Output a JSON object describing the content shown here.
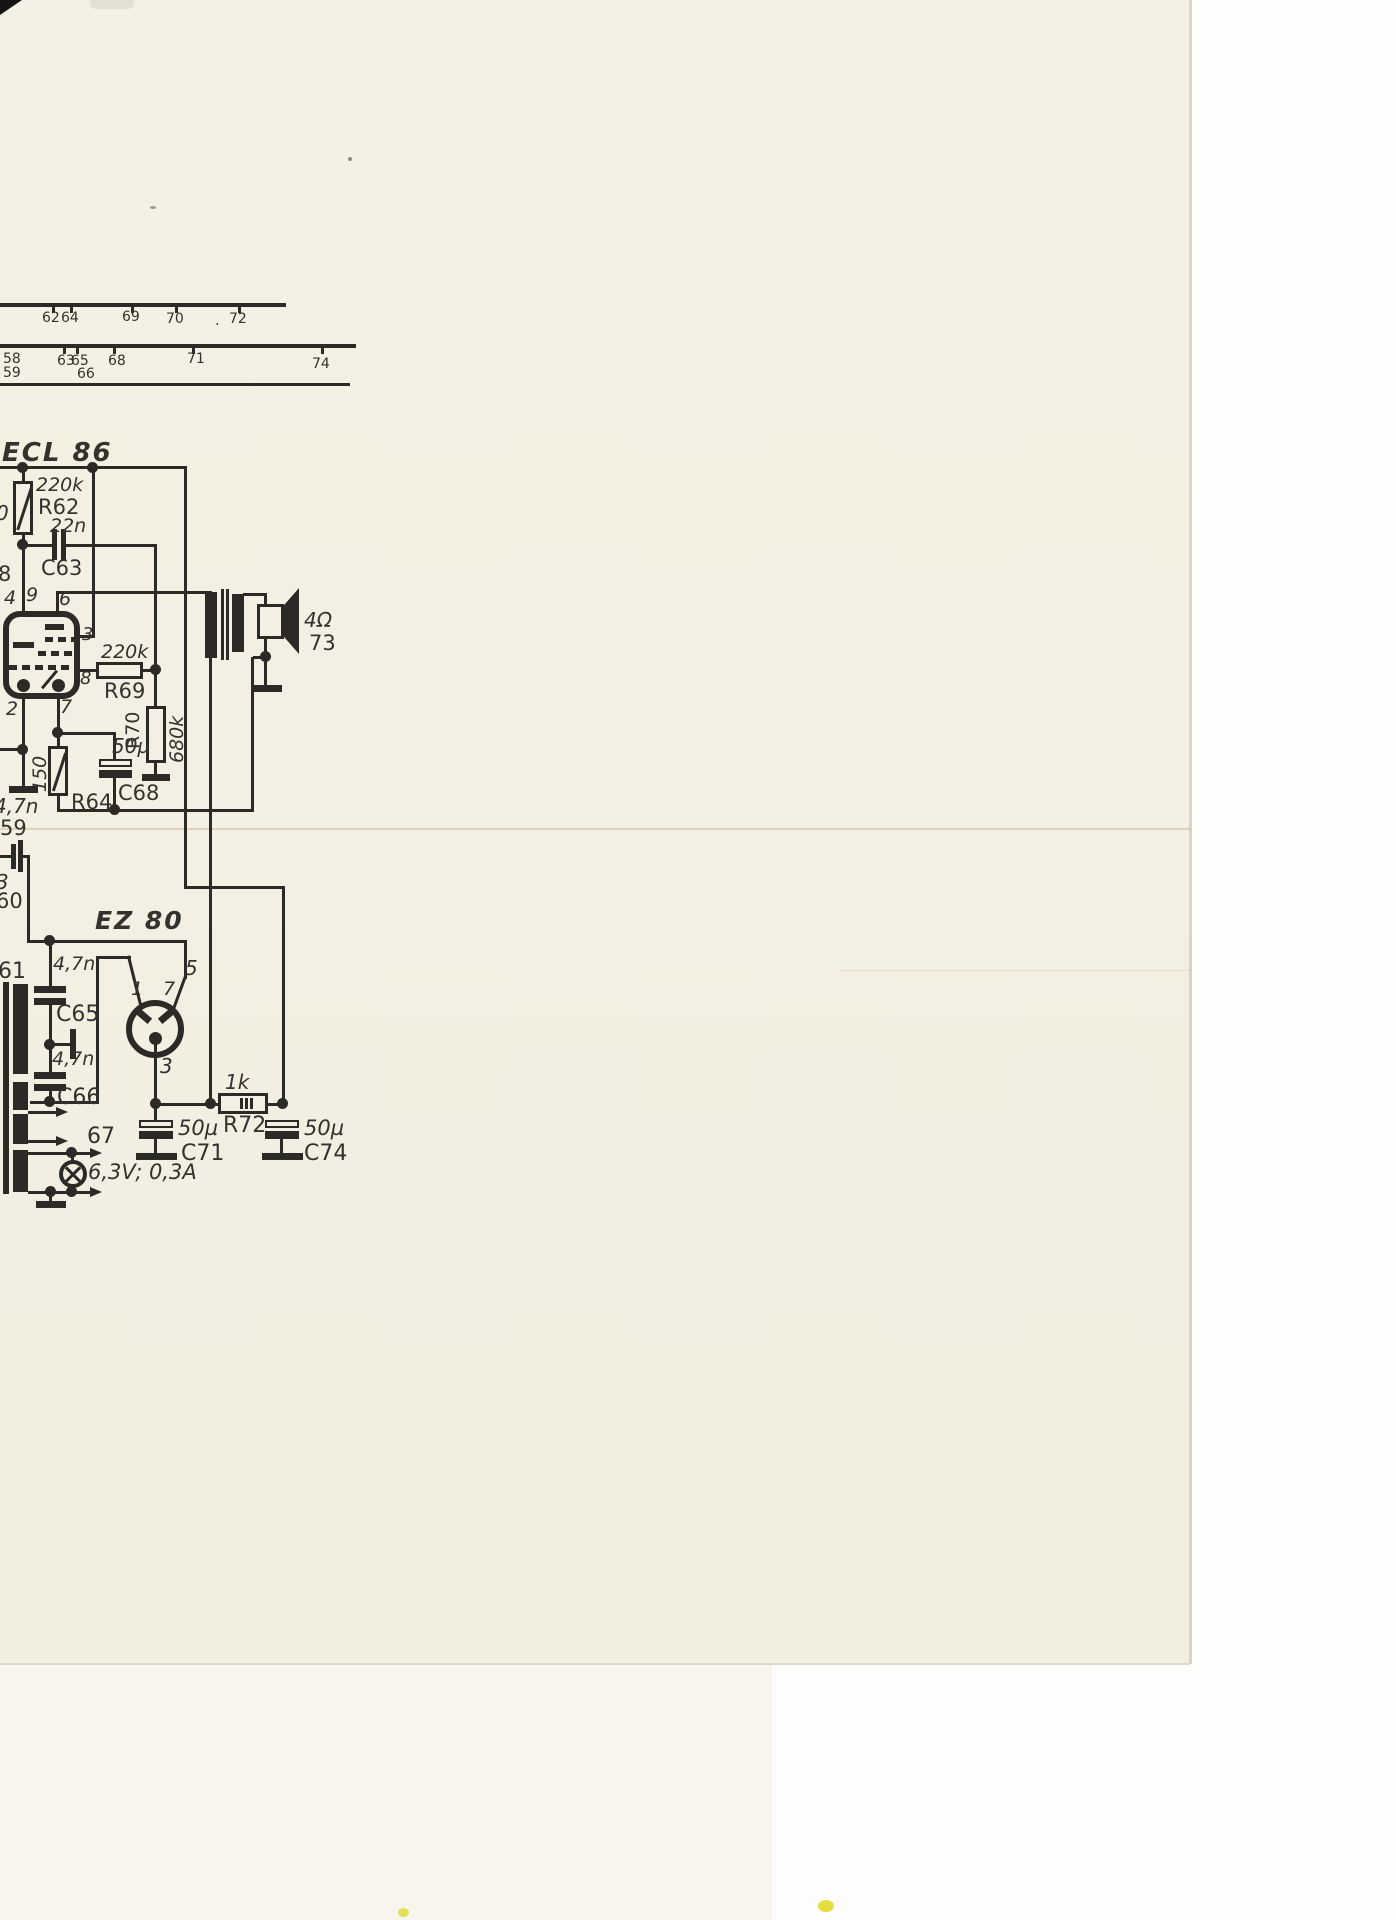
{
  "dial": {
    "row1": [
      "62",
      "64",
      "69",
      "70",
      "72"
    ],
    "row1_dot": ".",
    "row2": [
      "58",
      "59",
      "63",
      "65",
      "66",
      "68",
      "71",
      "74"
    ]
  },
  "ecl86": {
    "title": "ECL 86",
    "r62_value": "220k",
    "r62_ref": "R62",
    "c63_value": "22n",
    "c63_ref": "C63",
    "r69_value": "220k",
    "r69_ref": "R69",
    "r70_ref": "R70",
    "r70_value": "680k",
    "c68_value": "50µ",
    "c68_ref": "C68",
    "r64_value": "150",
    "r64_ref": "R64",
    "pin4": "4",
    "pin9": "9",
    "pin6": "6",
    "pin3": "3",
    "pin8": "8",
    "pin2": "2",
    "pin7": "7"
  },
  "output": {
    "speaker_impedance": "4Ω",
    "speaker_ref": "73"
  },
  "fragments": {
    "left_edge_1": "0",
    "left_edge_2": "8",
    "c59_value": "4,7n",
    "c59_ref": "59",
    "c60_value": "3",
    "c60_ref": "60",
    "c61_ref": "61"
  },
  "ez80": {
    "title": "EZ 80",
    "pin1": "1",
    "pin7": "7",
    "pin5": "5",
    "pin3": "3",
    "c65_value": "4,7n",
    "c65_ref": "C65",
    "c66_value": "4,7n",
    "c66_ref": "C66",
    "r72_value": "1k",
    "r72_ref": "R72",
    "c71_value": "50µ",
    "c71_ref": "C71",
    "c74_value": "50µ",
    "c74_ref": "C74"
  },
  "lamp": {
    "ref": "67",
    "rating": "6,3V; 0,3A"
  },
  "colors": {
    "ink": "#2c2a26",
    "paper": "#f3efe2",
    "background": "#fdfdfb"
  }
}
